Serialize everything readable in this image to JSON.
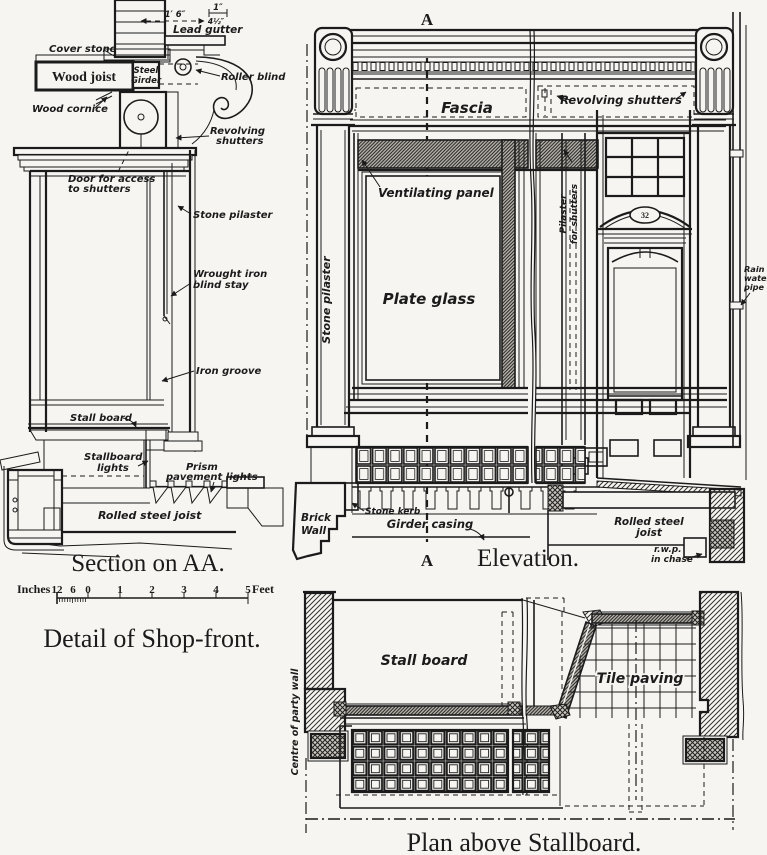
{
  "page": {
    "paper_color": "#f6f5f1",
    "ink_color": "#1b1b1b"
  },
  "captions": {
    "section": "Section on AA.",
    "detail": "Detail of Shop-front.",
    "elevation": "Elevation.",
    "plan": "Plan above Stallboard."
  },
  "scale_bar": {
    "left_unit": "Inches",
    "right_unit": "Feet",
    "inch_ticks": [
      "12",
      "6",
      "0"
    ],
    "feet_ticks": [
      "1",
      "2",
      "3",
      "4",
      "5"
    ]
  },
  "section": {
    "dims": {
      "gutter_width": "1′ 6″",
      "gutter_depth": "1″",
      "side": "4½″"
    },
    "labels": {
      "cover_stone": "Cover stone",
      "lead_gutter": "Lead gutter",
      "wood_joist": "Wood joist",
      "steel_girder_lines": [
        "Steel",
        "Girder"
      ],
      "wood_cornice": "Wood cornice",
      "roller_blind": "Roller blind",
      "revolving_shutters_lines": [
        "Revolving",
        "shutters"
      ],
      "door_access_lines": [
        "Door for access",
        "to shutters"
      ],
      "stone_pilaster": "Stone pilaster",
      "blind_stay_lines": [
        "Wrought iron",
        "blind stay"
      ],
      "iron_groove": "Iron groove",
      "stall_board": "Stall board",
      "stallboard_lights_lines": [
        "Stallboard",
        "lights"
      ],
      "prism_lights_lines": [
        "Prism",
        "pavement lights"
      ],
      "rolled_steel_joist": "Rolled steel joist"
    }
  },
  "elevation": {
    "marker_top": "A",
    "marker_bottom": "A",
    "labels": {
      "fascia": "Fascia",
      "revolving_shutters": "Revolving shutters",
      "ventilating_panel": "Ventilating panel",
      "plate_glass": "Plate glass",
      "stone_pilaster": "Stone pilaster",
      "pilaster_for_shutters_lines": [
        "Pilaster",
        "for shutters"
      ],
      "rain_water_pipe_lines": [
        "Rain",
        "water",
        "pipe"
      ],
      "brick_wall_lines": [
        "Brick",
        "Wall"
      ],
      "stone_kerb": "Stone kerb",
      "girder_casing": "Girder casing",
      "rolled_steel_joist_lines": [
        "Rolled steel",
        "joist"
      ],
      "rwp_lines": [
        "r.w.p.",
        "in chase"
      ],
      "door_number": "32"
    }
  },
  "plan": {
    "labels": {
      "centre_party_wall": "Centre of party wall",
      "stall_board": "Stall board",
      "tile_paving": "Tile paving"
    }
  }
}
